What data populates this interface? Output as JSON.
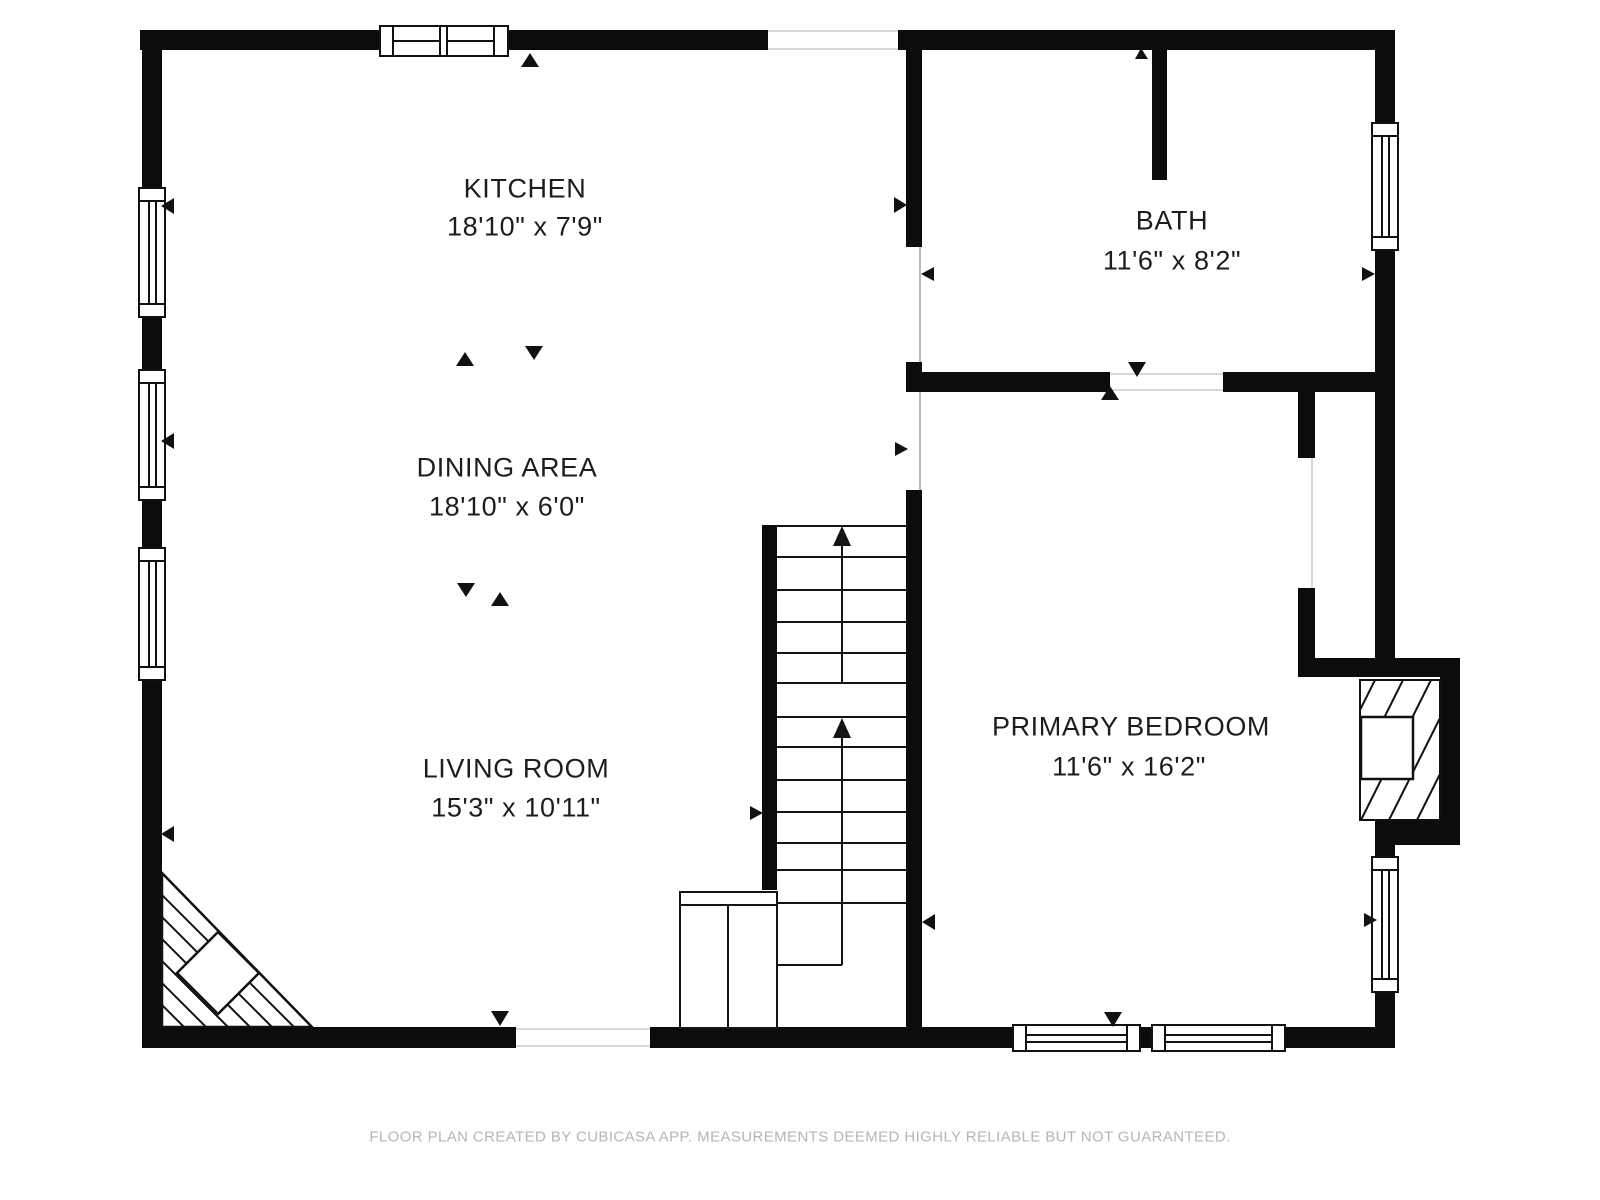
{
  "colors": {
    "wall": "#0c0c0c",
    "line": "#141414",
    "label_text": "#1d1d1d",
    "footer_text": "#b5b5b5",
    "background": "#ffffff",
    "opening_edge": "#d8d8d8"
  },
  "rooms": [
    {
      "id": "kitchen",
      "label": "KITCHEN",
      "dimensions": "18'10\" x 7'9\""
    },
    {
      "id": "dining_area",
      "label": "DINING AREA",
      "dimensions": "18'10\" x 6'0\""
    },
    {
      "id": "living_room",
      "label": "LIVING ROOM",
      "dimensions": "15'3\" x 10'11\""
    },
    {
      "id": "bath",
      "label": "BATH",
      "dimensions": "11'6\" x 8'2\""
    },
    {
      "id": "primary_bedroom",
      "label": "PRIMARY BEDROOM",
      "dimensions": "11'6\" x 16'2\""
    }
  ],
  "footer": {
    "disclaimer": "FLOOR PLAN CREATED BY CUBICASA APP. MEASUREMENTS DEEMED HIGHLY RELIABLE BUT NOT GUARANTEED."
  }
}
